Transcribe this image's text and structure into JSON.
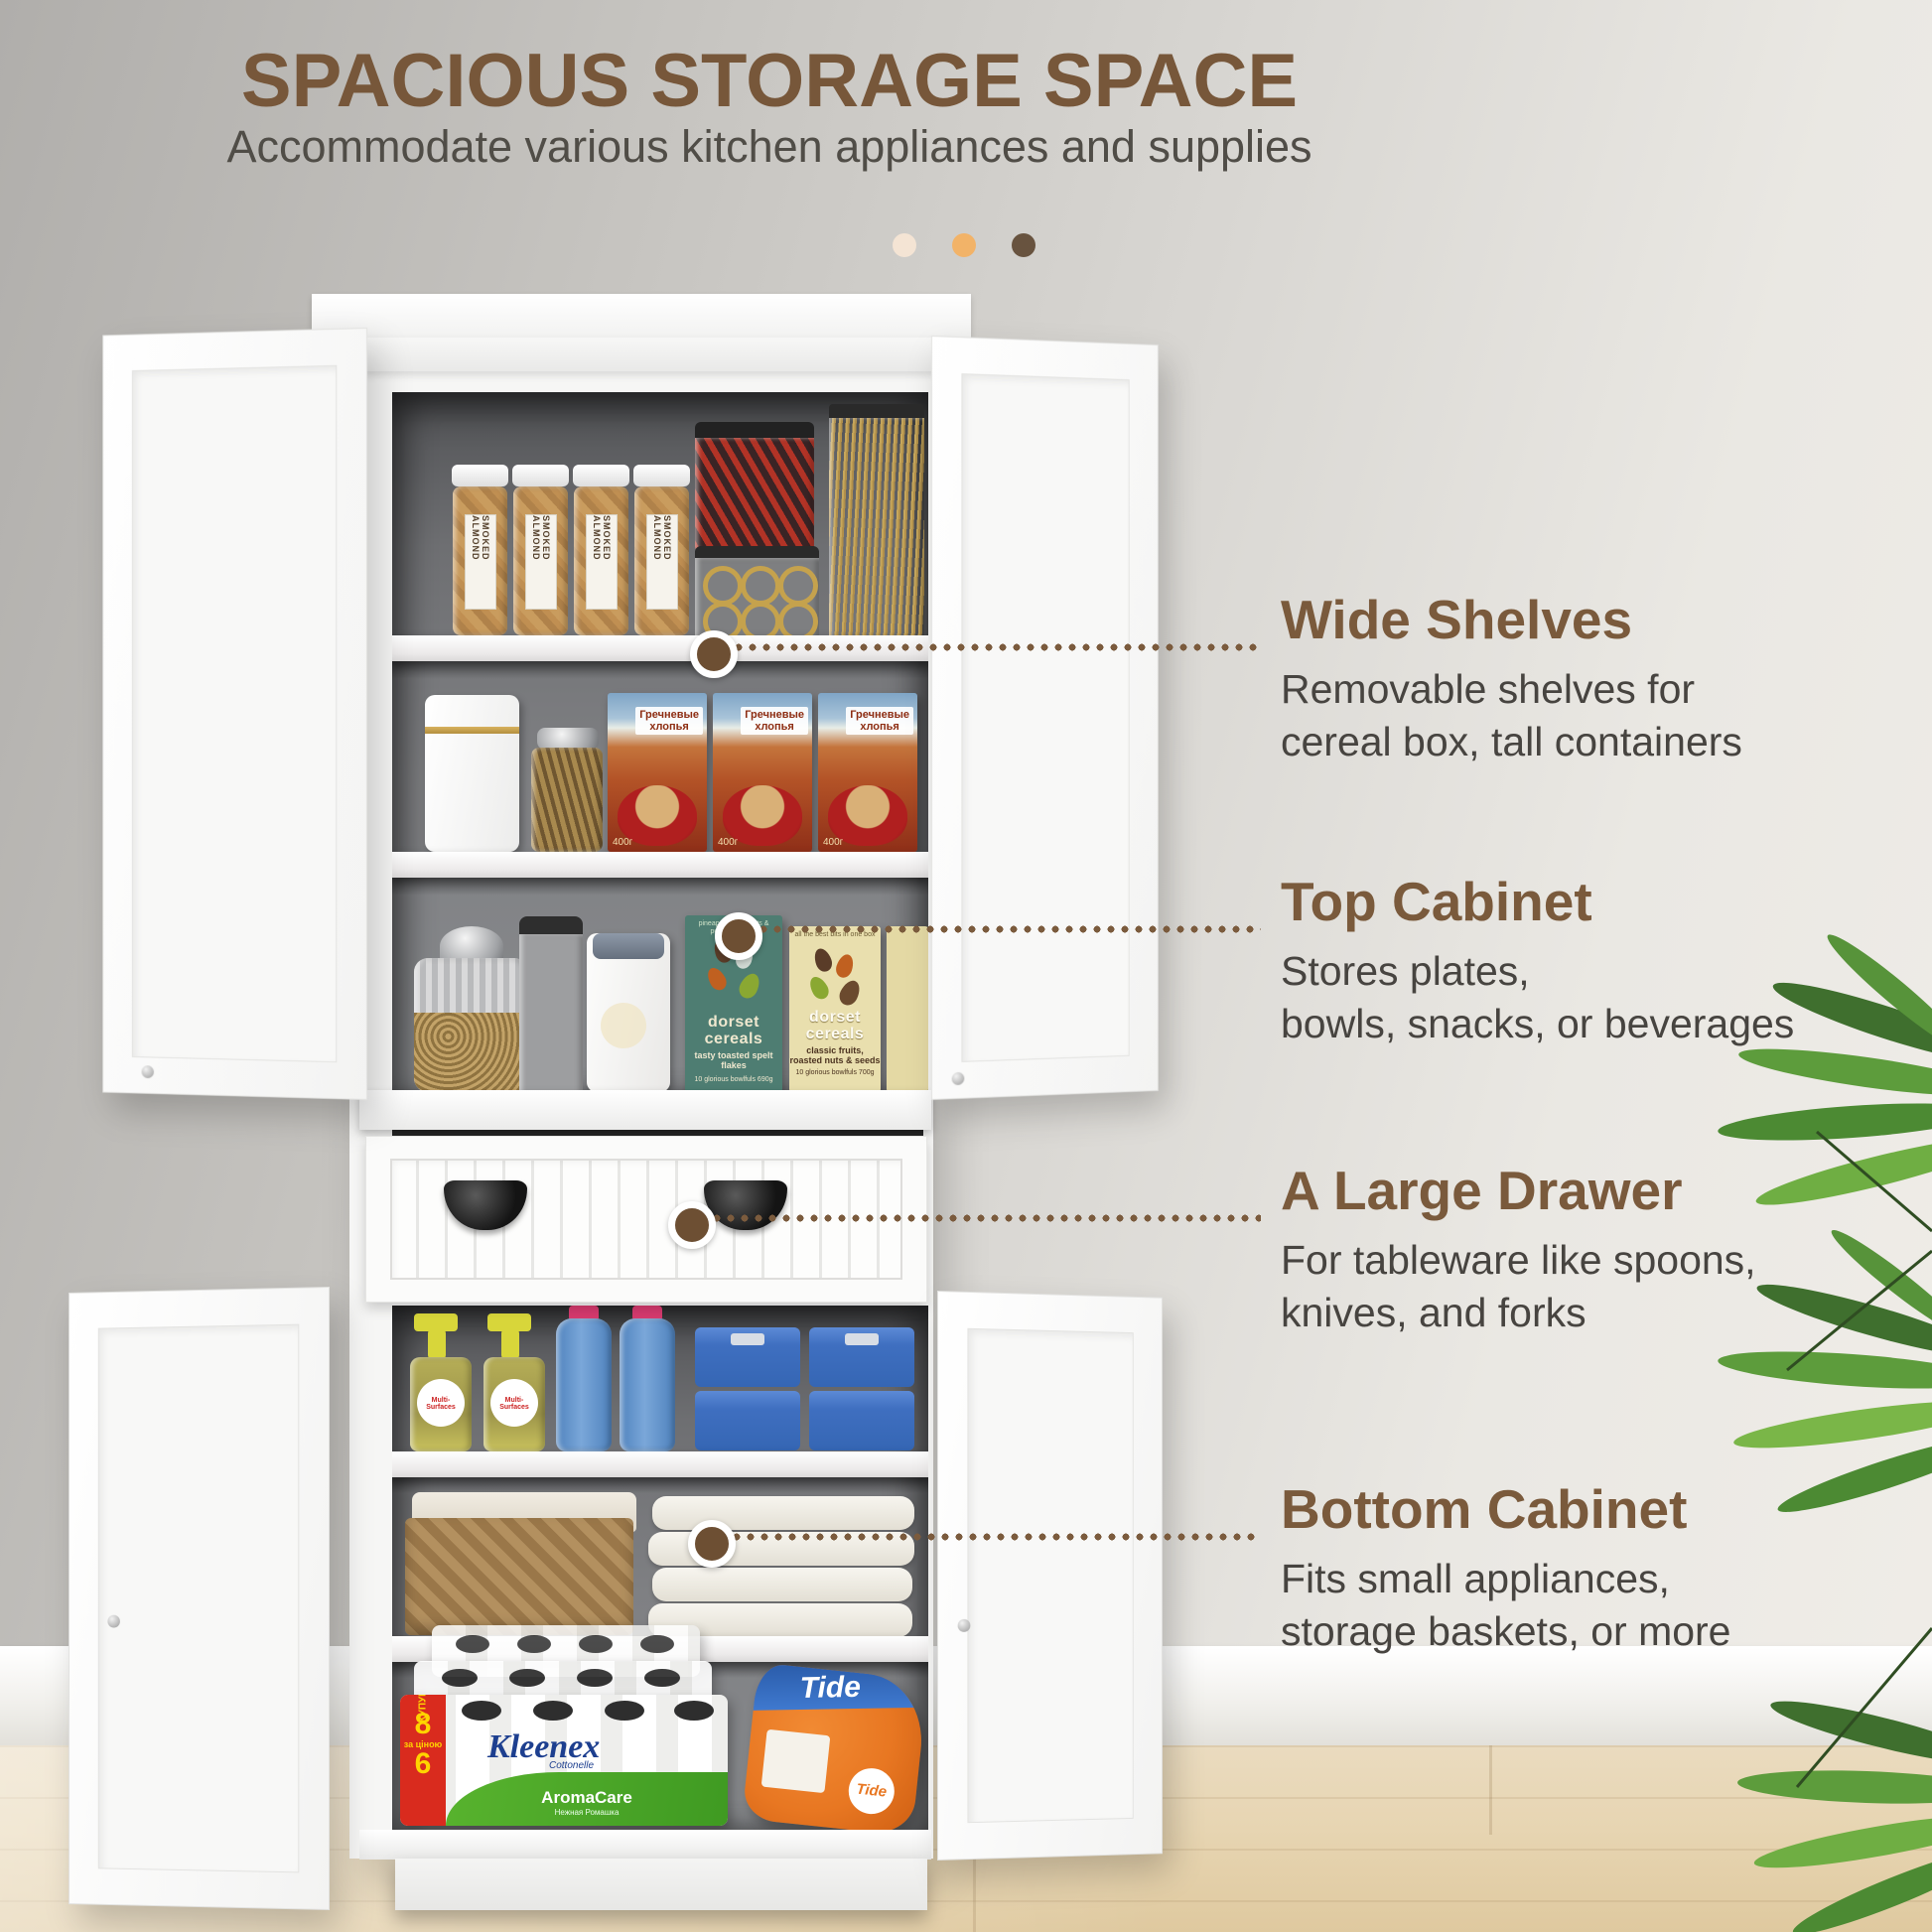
{
  "header": {
    "title": "SPACIOUS STORAGE SPACE",
    "subtitle": "Accommodate various kitchen appliances and supplies"
  },
  "callouts": [
    {
      "heading": "Wide Shelves",
      "line1": "Removable shelves for",
      "line2": "cereal box, tall containers"
    },
    {
      "heading": "Top Cabinet",
      "line1": "Stores plates,",
      "line2": "bowls, snacks, or beverages"
    },
    {
      "heading": "A Large Drawer",
      "line1": "For tableware like spoons,",
      "line2": "knives, and forks"
    },
    {
      "heading": "Bottom Cabinet",
      "line1": "Fits small appliances,",
      "line2": "storage baskets, or more"
    }
  ],
  "products": {
    "almond_jar_label": "SMOKED ALMOND",
    "cereal_box_title_line1": "Гречневые",
    "cereal_box_title_line2": "хлопья",
    "cereal_box_weight": "400г",
    "dorset_brand_line1": "dorset",
    "dorset_brand_line2": "cereals",
    "dorset_teal_tagline": "pineapple, hazelnuts & pumpkin seeds",
    "dorset_teal_variant": "tasty toasted spelt flakes",
    "dorset_teal_footer": "10 glorious bowlfuls 690g",
    "dorset_cream_tagline": "all the best bits in one box",
    "dorset_cream_variant": "classic fruits, roasted nuts & seeds",
    "dorset_cream_footer": "10 glorious bowlfuls 700g",
    "spray_label": "Multi-Surfaces",
    "kleenex_brand": "Kleenex",
    "kleenex_sub": "Cottonelle",
    "kleenex_variant": "AromaCare",
    "kleenex_variant_sub": "Нежная Ромашка",
    "kleenex_promo_word": "КУПУЙ!",
    "kleenex_promo_top": "8",
    "kleenex_promo_mid": "за ціною",
    "kleenex_promo_bottom": "6",
    "tide_brand": "Tide"
  },
  "colors": {
    "accent_brown": "#77573a",
    "body_text": "#474440",
    "accent_dots": [
      "#f4e4d4",
      "#f2b368",
      "#68533f"
    ],
    "callout_dot": "#6d4f33",
    "cabinet_white": "#f6f6f5",
    "interior_gray": "#7f8083",
    "floor_wood": "#e7d5b2"
  }
}
